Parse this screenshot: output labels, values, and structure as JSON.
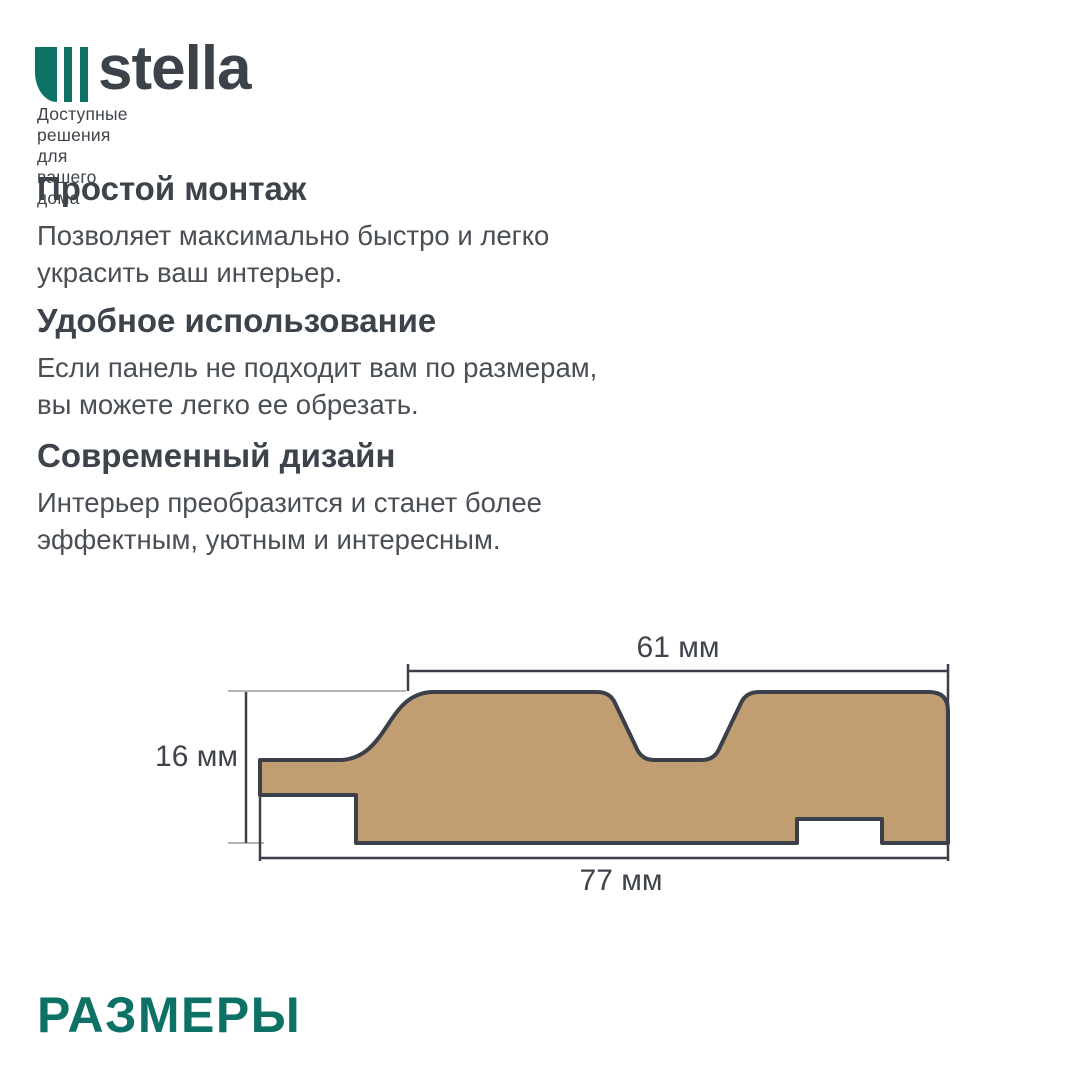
{
  "header": {
    "brand": "stella",
    "tagline": "Доступные решения для вашего дома"
  },
  "features": [
    {
      "title": "Простой монтаж",
      "body": "Позволяет максимально быстро и легко\nукрасить ваш интерьер."
    },
    {
      "title": "Удобное использование",
      "body": "Если панель не подходит вам по размерам,\nвы можете легко ее обрезать."
    },
    {
      "title": "Современный дизайн",
      "body": "Интерьер преобразится и станет более\nэффектным, уютным и интересным."
    }
  ],
  "diagram": {
    "dim_top_label": "61 мм",
    "dim_left_label": "16 мм",
    "dim_bottom_label": "77 мм",
    "panel_fill": "#c09e71",
    "outline_color": "#3a3f49",
    "extension_color": "#ababab"
  },
  "section_title": "РАЗМЕРЫ",
  "colors": {
    "brand_teal": "#0d7165",
    "heading_text": "#3d434b",
    "body_text": "#4a4f56"
  }
}
